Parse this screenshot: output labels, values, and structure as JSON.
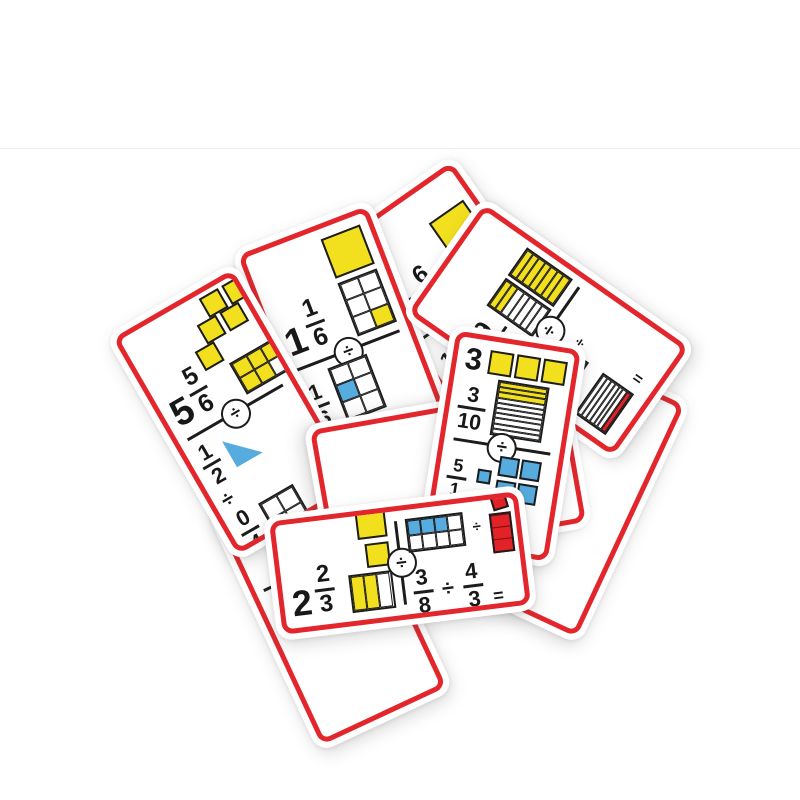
{
  "scene": {
    "description": "Product photo: a scattered pile of red-bordered fraction-division domino flash cards on a white background",
    "background": "#ffffff",
    "photo_edge_line_y": 148
  },
  "colors": {
    "card_border": "#e2262c",
    "card_face": "#ffffff",
    "yellow": "#f2e01e",
    "blue": "#56acdf",
    "red": "#e32227",
    "ink": "#1c1c1c"
  },
  "symbols": {
    "divide": "÷",
    "equals": "="
  },
  "cards": [
    {
      "name": "card-5-5-6",
      "z": 8,
      "x": 235,
      "y": 412,
      "w": 150,
      "h": 262,
      "rot": -30,
      "orientation": "portrait",
      "answer": {
        "whole": "5",
        "num": "5",
        "den": "6",
        "graphics": [
          {
            "type": "cluster",
            "color": "y",
            "size": 22,
            "cw": 78,
            "ch": 66,
            "offsets": [
              [
                30,
                0
              ],
              [
                56,
                0
              ],
              [
                15,
                22
              ],
              [
                41,
                22
              ],
              [
                0,
                44
              ]
            ]
          },
          {
            "type": "grid",
            "cols": 3,
            "rows": 2,
            "cells": "yyyyyw",
            "w": 54,
            "h": 36
          }
        ]
      },
      "problem": {
        "f1": {
          "num": "1",
          "den": "2"
        },
        "f2": {
          "num": "0",
          "den": "4"
        },
        "eq": "normal",
        "g1": {
          "type": "halfsquare",
          "color": "b",
          "size": 30
        },
        "g2": {
          "type": "grid",
          "cols": 2,
          "rows": 2,
          "cells": "wwww",
          "w": 40,
          "h": 40
        }
      }
    },
    {
      "name": "card-1-1-6",
      "z": 6,
      "x": 348,
      "y": 350,
      "w": 150,
      "h": 268,
      "rot": -21,
      "orientation": "portrait",
      "answer": {
        "whole": "1",
        "num": "1",
        "den": "6",
        "graphics": [
          {
            "type": "square",
            "color": "y",
            "size": 42
          },
          {
            "type": "grid",
            "cols": 2,
            "rows": 3,
            "cells": "wwwwwy",
            "w": 42,
            "h": 57
          }
        ]
      },
      "problem": {
        "f1": {
          "num": "1",
          "den": "6"
        },
        "f2": {
          "num": "1",
          "den": "1"
        },
        "eq": "rot",
        "midop": true,
        "g1": {
          "type": "grid",
          "cols": 2,
          "rows": 3,
          "cells": "wwbwww",
          "w": 42,
          "h": 57
        },
        "g2": {
          "type": "square",
          "color": "r",
          "size": 40
        }
      }
    },
    {
      "name": "card-1-6-8",
      "z": 5,
      "x": 468,
      "y": 306,
      "w": 150,
      "h": 268,
      "rot": -35,
      "orientation": "portrait",
      "answer": {
        "whole": "1",
        "num": "6",
        "den": "8",
        "graphics": [
          {
            "type": "square",
            "color": "y",
            "size": 42
          },
          {
            "type": "grid",
            "cols": 4,
            "rows": 2,
            "cells": "yyywyyyw",
            "w": 62,
            "h": 34
          }
        ]
      },
      "problem": {
        "f1": {
          "num": "14",
          "den": "18"
        },
        "f2": {
          "num": "2",
          "den": ""
        },
        "eq": null,
        "g1": {
          "type": "grid",
          "cols": 3,
          "rows": 6,
          "cells": "bbbbbbbbbbbbbbwwww",
          "w": 36,
          "h": 62
        },
        "g2": null
      }
    },
    {
      "name": "card-9-14",
      "z": 7,
      "x": 548,
      "y": 330,
      "w": 145,
      "h": 262,
      "rot": -55,
      "orientation": "portrait",
      "answer": {
        "whole": "",
        "num": "9",
        "den": "14",
        "graphics": [
          {
            "type": "stripepair",
            "stripes": 7,
            "left": "yywwwww",
            "right": "yyyyyyy",
            "w": 34,
            "h": 56
          }
        ]
      },
      "problem": {
        "graphics_only": true,
        "eq": "rot",
        "midop": true,
        "g1": {
          "type": "stripes",
          "n": 7,
          "cells": "bbbbbbb",
          "w": 50,
          "h": 38
        },
        "g2": {
          "type": "stripes",
          "n": 7,
          "cells": "wwwwwwr",
          "w": 50,
          "h": 38
        }
      }
    },
    {
      "name": "card-3-3-10",
      "z": 10,
      "x": 502,
      "y": 446,
      "w": 138,
      "h": 226,
      "rot": 9,
      "orientation": "portrait",
      "fs": 0.82,
      "answer": {
        "layout": "rows",
        "rows": [
          {
            "whole": "3",
            "graphics": [
              {
                "type": "rowsquares",
                "color": "y",
                "count": 3,
                "size": 24
              }
            ]
          },
          {
            "num": "3",
            "den": "10",
            "graphics": [
              {
                "type": "stripes",
                "n": 10,
                "cells": "yyywwwwwww",
                "w": 52,
                "h": 56
              }
            ]
          }
        ]
      },
      "problem": {
        "f1": {
          "num": "5",
          "den": "1"
        },
        "f2": {
          "num": "1",
          "den": "5"
        },
        "eq": "rot",
        "midop": true,
        "g1": {
          "type": "fiveblue",
          "w": 62,
          "h": 50
        },
        "g2": {
          "type": "stripes",
          "n": 5,
          "cells": "wwwwr",
          "w": 46,
          "h": 46
        }
      }
    },
    {
      "name": "card-2-2-3",
      "z": 11,
      "x": 400,
      "y": 563,
      "w": 262,
      "h": 126,
      "rot": -7,
      "orientation": "landscape",
      "fs": 0.95,
      "answer": {
        "whole": "2",
        "num": "2",
        "den": "3",
        "graphics": [
          {
            "type": "square",
            "color": "y",
            "size": 30
          },
          {
            "type": "square",
            "color": "y",
            "size": 24
          },
          {
            "type": "cols",
            "cols": 3,
            "cells": "yyw",
            "w": 44,
            "h": 38
          }
        ]
      },
      "problem": {
        "f1": {
          "num": "3",
          "den": "8"
        },
        "f2": {
          "num": "4",
          "den": "3"
        },
        "eq": "normal",
        "midop": true,
        "g1": {
          "type": "grid",
          "cols": 4,
          "rows": 2,
          "cells": "bbbwwwww",
          "w": 58,
          "h": 34
        },
        "g2": {
          "type": "improper",
          "w": 38,
          "h": 58
        }
      }
    },
    {
      "name": "card-under-yellow-grid",
      "z": 1,
      "x": 352,
      "y": 428,
      "w": 150,
      "h": 268,
      "rot": -40,
      "orientation": "portrait",
      "fragment": "graphic",
      "answer": {
        "graphics": [
          {
            "type": "grid",
            "cols": 4,
            "rows": 3,
            "cells": "yyyyyyyyyyyy",
            "w": 84,
            "h": 62
          }
        ]
      }
    },
    {
      "name": "card-under-logo",
      "z": 2,
      "x": 330,
      "y": 600,
      "w": 150,
      "h": 268,
      "rot": -25,
      "orientation": "portrait",
      "fragment": "logo",
      "answer": {
        "num": "",
        "den": "4"
      }
    },
    {
      "name": "card-under-strip",
      "z": 4,
      "x": 415,
      "y": 362,
      "w": 150,
      "h": 268,
      "rot": -80,
      "orientation": "portrait",
      "fragment": "graphic",
      "answer": {
        "graphics": [
          {
            "type": "stripes",
            "n": 5,
            "cells": "bbbbb",
            "w": 16,
            "h": 46
          },
          {
            "type": "redbar",
            "color": "r",
            "w": 14,
            "h": 38
          }
        ]
      }
    },
    {
      "name": "card-under-circle",
      "z": 9,
      "x": 448,
      "y": 476,
      "w": 150,
      "h": 268,
      "rot": 80,
      "orientation": "portrait",
      "fragment": "blank"
    },
    {
      "name": "card-under-right",
      "z": 3,
      "x": 568,
      "y": 492,
      "w": 150,
      "h": 268,
      "rot": 25,
      "orientation": "portrait",
      "fragment": "blank",
      "divider": false
    }
  ]
}
